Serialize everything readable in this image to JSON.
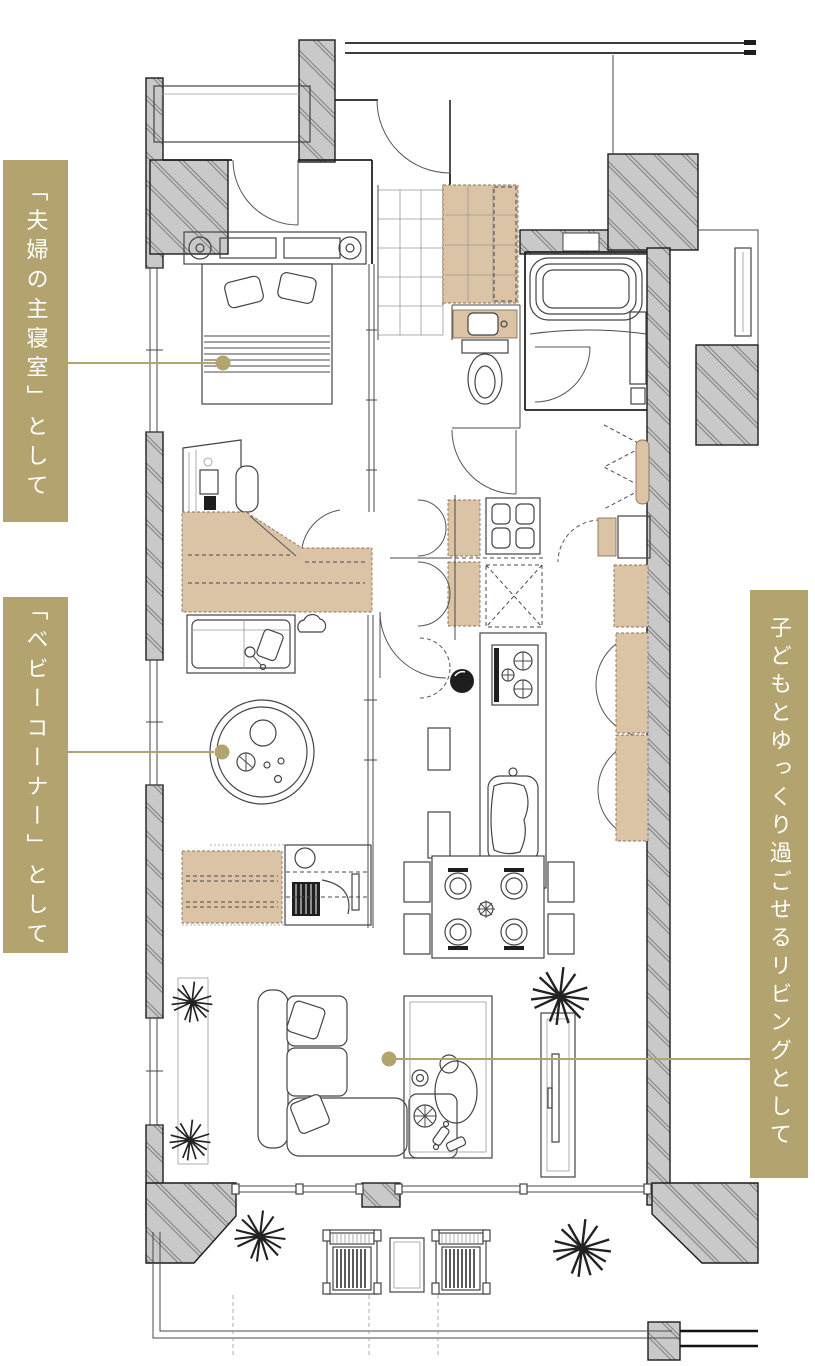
{
  "annotations": {
    "labels": [
      {
        "id": "master-bedroom",
        "text": "「夫婦の主寝室」として"
      },
      {
        "id": "baby-corner",
        "text": "「ベビーコーナー」として"
      },
      {
        "id": "living",
        "text": "子どもとゆっくり過ごせるリビングとして"
      }
    ]
  },
  "colors": {
    "label_background": "#b3a46f",
    "label_text": "#ffffff",
    "connector": "#b3a46f",
    "wall_fill": "#c9c9c9",
    "closet_fill": "#dbc3a5",
    "line": "#2b2b2b",
    "background": "#ffffff"
  }
}
